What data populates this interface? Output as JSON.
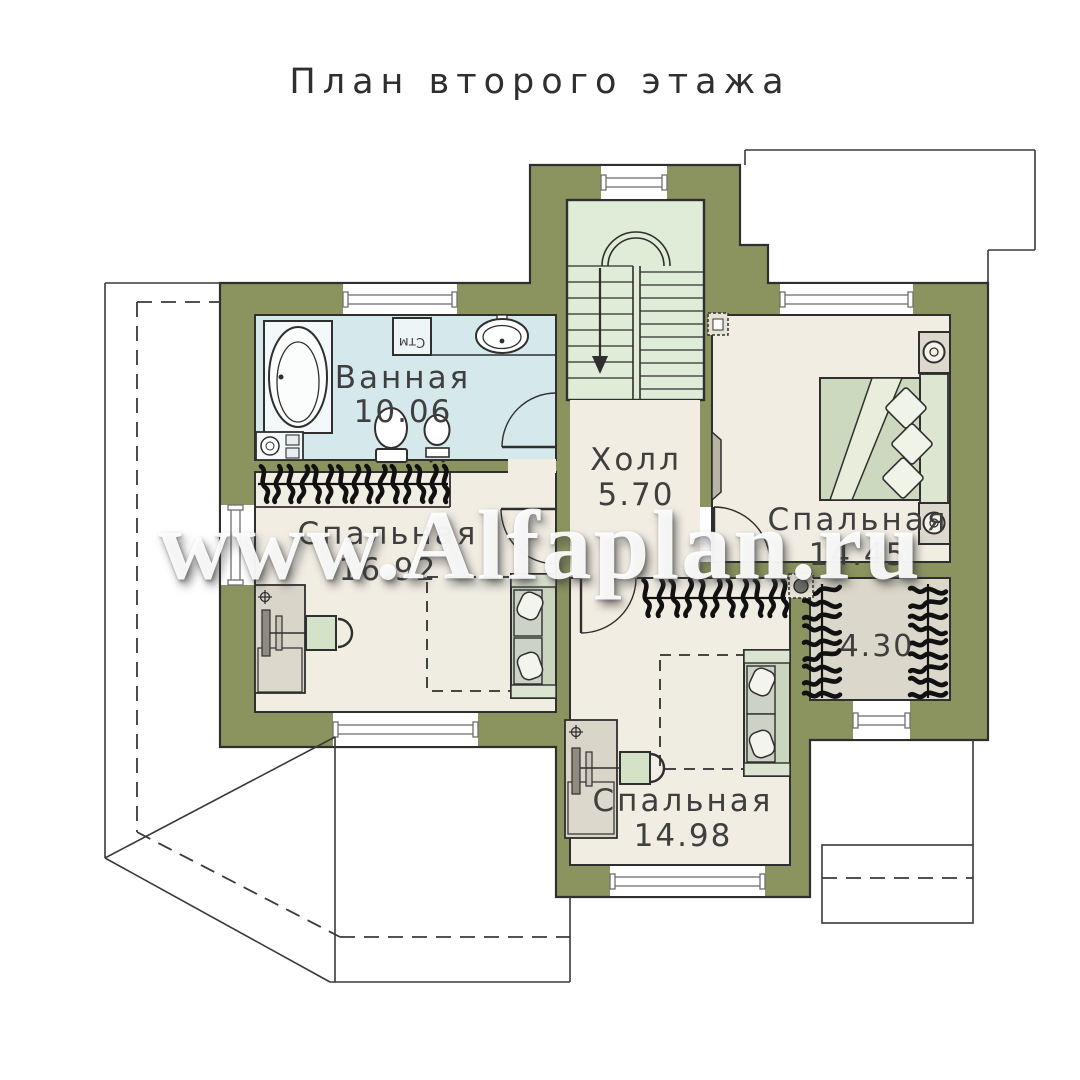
{
  "title": "План второго этажа",
  "watermark": "www.Alfaplan.ru",
  "rooms": {
    "bathroom": {
      "name": "Ванная",
      "area": "10.06"
    },
    "hall": {
      "name": "Холл",
      "area": "5.70"
    },
    "bedroom_left": {
      "name": "Спальная",
      "area": "16.92"
    },
    "bedroom_right": {
      "name": "Спальная",
      "area": "14.45"
    },
    "bedroom_bottom": {
      "name": "Спальная",
      "area": "14.98"
    },
    "wardrobe": {
      "area": "4.30"
    }
  },
  "labels": {
    "washing_machine": "Стм"
  },
  "colors": {
    "wall_olive": "#8b945f",
    "room_beige": "#f2ede3",
    "bathroom_blue": "#d5e9ec",
    "stair_green": "#dfecd7",
    "wardrobe_gray": "#dbd7ca",
    "line_dark": "#2f2f2f"
  }
}
